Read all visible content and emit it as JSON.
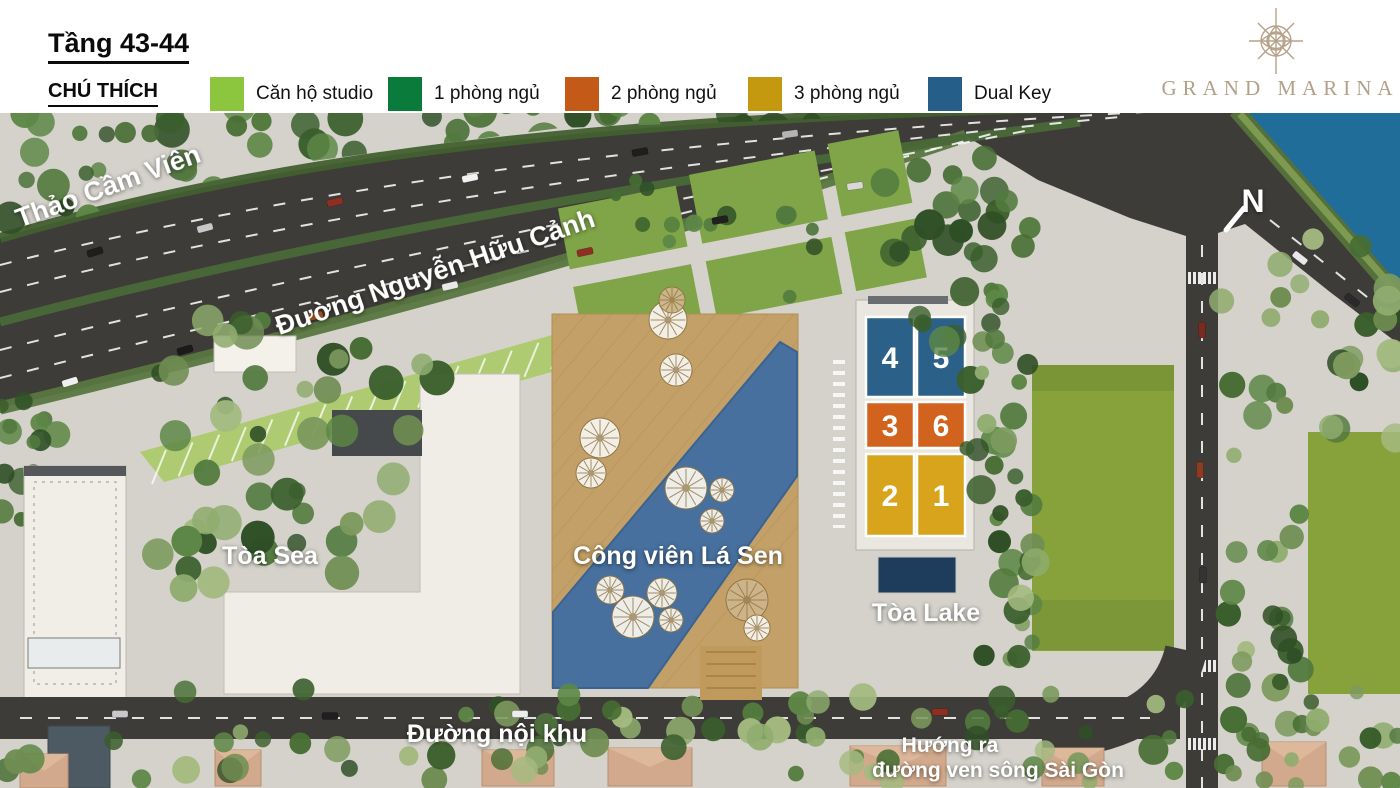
{
  "header": {
    "floor_title": "Tầng 43-44",
    "legend_title": "CHÚ THÍCH",
    "legend": [
      {
        "label": "Căn hộ studio",
        "color": "#8cc63e"
      },
      {
        "label": "1 phòng ngủ",
        "color": "#0b7b3b"
      },
      {
        "label": "2 phòng ngủ",
        "color": "#c35a17"
      },
      {
        "label": "3 phòng ngủ",
        "color": "#c5990f"
      },
      {
        "label": "Dual Key",
        "color": "#255e88"
      }
    ],
    "brand": {
      "name": "GRAND MARINA",
      "color": "#b3a089"
    }
  },
  "map": {
    "labels": {
      "zoo": "Thảo Cầm Viên",
      "main_road": "Đường Nguyễn Hữu Cảnh",
      "sea_tower": "Tòa Sea",
      "park": "Công viên Lá Sen",
      "lake_tower": "Tòa Lake",
      "internal_road": "Đường nội khu",
      "river_direction_line1": "Hướng ra",
      "river_direction_line2": "đường ven sông Sài Gòn",
      "north": "N"
    },
    "lake_units": [
      {
        "label": "4",
        "color": "#2b6189"
      },
      {
        "label": "5",
        "color": "#2b6189"
      },
      {
        "label": "3",
        "color": "#d2631f"
      },
      {
        "label": "6",
        "color": "#d2631f"
      },
      {
        "label": "2",
        "color": "#d8a41b"
      },
      {
        "label": "1",
        "color": "#d8a41b"
      }
    ],
    "colors": {
      "river": "#216d99",
      "park_water": "#47709f",
      "park_deck": "#c3a067",
      "asphalt": "#3e3c38",
      "lawn": "#87a23b",
      "concrete": "#d4d2ca",
      "pool": "#1e3c5c"
    }
  }
}
